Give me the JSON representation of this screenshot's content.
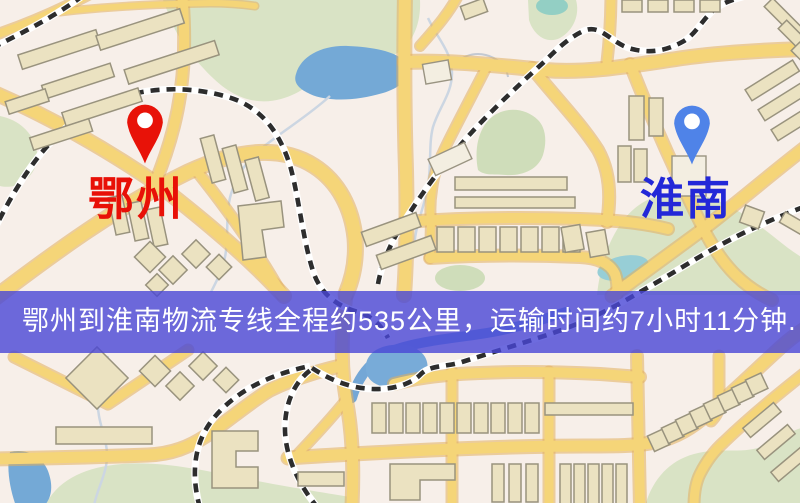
{
  "map": {
    "origin": {
      "name": "鄂州",
      "marker_color": "#e81208",
      "label_color": "#e81007"
    },
    "destination": {
      "name": "淮南",
      "marker_color": "#4f83e8",
      "label_color": "#2328d8"
    },
    "banner": {
      "text": "鄂州到淮南物流专线全程约535公里，运输时间约7小时11分钟.",
      "bg_color": "rgba(73,70,214,0.80)",
      "text_color": "#ffffff"
    },
    "route": {
      "distance_km": "535",
      "duration_hours": "7",
      "duration_minutes": "11"
    }
  },
  "palette": {
    "background": "#f7efe9",
    "road_fill": "#f5d578",
    "road_casing": "#e2af5c",
    "water": "#74a9d6",
    "green_area": "#d9e3c5",
    "railway_dash": "#2d2d2d",
    "building_fill": "#ebe2c1"
  }
}
